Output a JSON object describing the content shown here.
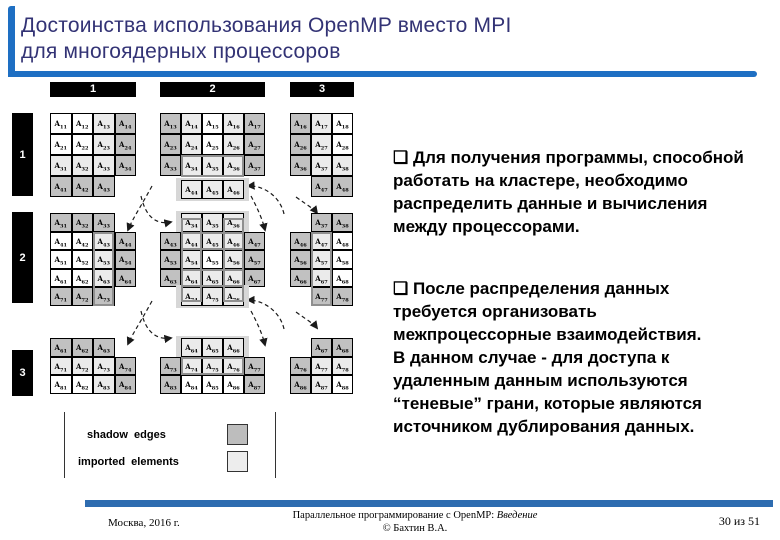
{
  "colors": {
    "accent_blue": "#1e6fc3",
    "title_text": "#333375",
    "footer_bar": "#2e6cb0",
    "shadow_gray": "#c1c1c1",
    "imported_gray": "#ebebeb"
  },
  "title": {
    "line1": "Достоинства использования OpenMP вместо MPI",
    "line2": "для многоядерных процессоров"
  },
  "bullets": {
    "item1": "❑  Для получения программы, способной\nработать на кластере, необходимо\nраспределить данные  и вычисления\nмежду процессорами.",
    "item2": "❑  После распределения данных\nтребуется организовать\nмежпроцессорные взаимодействия.\nВ данном случае - для доступа к\nудаленным данным используются\n“теневые” грани, которые являются\nисточником дублирования данных."
  },
  "legend": {
    "shadow_label": "shadow  edges",
    "shadow_color": "#bdbdbd",
    "imported_label": "imported  elements",
    "imported_color": "#ededed"
  },
  "footer": {
    "left": "Москва, 2016 г.",
    "center_plain": "Параллельное программирование с OpenMP: ",
    "center_italic": "Введение",
    "center_line2": "© Бахтин В.А.",
    "right": "30 из 51"
  },
  "diagram": {
    "col_bars": [
      {
        "x": 50,
        "y": 82,
        "w": 86,
        "h": 15,
        "label": "1"
      },
      {
        "x": 160,
        "y": 82,
        "w": 105,
        "h": 15,
        "label": "2"
      },
      {
        "x": 290,
        "y": 82,
        "w": 64,
        "h": 15,
        "label": "3"
      }
    ],
    "row_bars": [
      {
        "x": 12,
        "y": 113,
        "w": 21,
        "h": 83,
        "label": "1"
      },
      {
        "x": 12,
        "y": 212,
        "w": 21,
        "h": 91,
        "label": "2"
      },
      {
        "x": 12,
        "y": 350,
        "w": 21,
        "h": 46,
        "label": "3"
      }
    ],
    "blocks": [
      {
        "name": "block-1-1",
        "x": 50,
        "y": 113,
        "cw": 21.5,
        "rh": 21,
        "rows": [
          {
            "o": 0,
            "c": [
              "11.w",
              "12.w",
              "13.i",
              "14.s"
            ]
          },
          {
            "o": 0,
            "c": [
              "21.w",
              "22.w",
              "23.i",
              "24.s"
            ]
          },
          {
            "o": 0,
            "c": [
              "31.i",
              "32.i",
              "33.i",
              "34.s"
            ]
          },
          {
            "o": 0,
            "c": [
              "41.s",
              "42.s",
              "43.s"
            ]
          }
        ]
      },
      {
        "name": "block-1-2",
        "x": 160,
        "y": 113,
        "cw": 21,
        "rh": 21,
        "rows": [
          {
            "o": 0,
            "c": [
              "13.s",
              "14.i",
              "15.w",
              "16.i",
              "17.s"
            ]
          },
          {
            "o": 0,
            "c": [
              "23.s",
              "24.i",
              "25.w",
              "26.i",
              "27.s"
            ]
          },
          {
            "o": 0,
            "c": [
              "33.s",
              "34.i",
              "35.i",
              "36.i",
              "37.s"
            ]
          }
        ]
      },
      {
        "name": "block-1-2-imported-strip",
        "x": 181,
        "y": 180,
        "cw": 21,
        "rh": 18.5,
        "band": true,
        "rows": [
          {
            "o": 0,
            "c": [
              "44.i",
              "45.i",
              "46.i"
            ]
          }
        ]
      },
      {
        "name": "block-1-3",
        "x": 290,
        "y": 113,
        "cw": 21,
        "rh": 21,
        "rows": [
          {
            "o": 0,
            "c": [
              "16.s",
              "17.i",
              "18.w"
            ]
          },
          {
            "o": 0,
            "c": [
              "26.s",
              "27.i",
              "28.w"
            ]
          },
          {
            "o": 0,
            "c": [
              "36.s",
              "37.i",
              "38.i"
            ]
          },
          {
            "o": 1,
            "c": [
              "47.s",
              "48.s"
            ]
          }
        ]
      },
      {
        "name": "block-2-1",
        "x": 50,
        "y": 213,
        "cw": 21.5,
        "rh": 18.5,
        "rows": [
          {
            "o": 0,
            "c": [
              "31.s",
              "32.s",
              "33.s"
            ]
          },
          {
            "o": 0,
            "c": [
              "41.w",
              "42.w",
              "43.i",
              "44.s"
            ]
          },
          {
            "o": 0,
            "c": [
              "51.w",
              "52.w",
              "53.i",
              "54.s"
            ]
          },
          {
            "o": 0,
            "c": [
              "61.w",
              "62.w",
              "63.i",
              "64.s"
            ]
          },
          {
            "o": 0,
            "c": [
              "71.s",
              "72.s",
              "73.s"
            ]
          }
        ]
      },
      {
        "name": "block-2-2-top-strip",
        "x": 181,
        "y": 213,
        "cw": 21,
        "rh": 18.5,
        "band": true,
        "rows": [
          {
            "o": 0,
            "c": [
              "34.i",
              "35.i",
              "36.i"
            ]
          }
        ]
      },
      {
        "name": "block-2-2",
        "x": 160,
        "y": 231.5,
        "cw": 21,
        "rh": 18.5,
        "rows": [
          {
            "o": 0,
            "c": [
              "43.s",
              "44.i",
              "45.i",
              "46.i",
              "47.s"
            ]
          },
          {
            "o": 0,
            "c": [
              "53.s",
              "54.i",
              "55.w",
              "56.i",
              "57.s"
            ]
          },
          {
            "o": 0,
            "c": [
              "63.s",
              "64.i",
              "65.i",
              "66.i",
              "67.s"
            ]
          }
        ]
      },
      {
        "name": "block-2-2-bottom-strip",
        "x": 181,
        "y": 287,
        "cw": 21,
        "rh": 18.5,
        "band": true,
        "rows": [
          {
            "o": 0,
            "c": [
              "74.i",
              "75.i",
              "76.i"
            ]
          }
        ]
      },
      {
        "name": "block-2-3",
        "x": 290,
        "y": 213,
        "cw": 21,
        "rh": 18.5,
        "rows": [
          {
            "o": 1,
            "c": [
              "37.s",
              "38.s"
            ]
          },
          {
            "o": 0,
            "c": [
              "46.s",
              "47.i",
              "48.w"
            ]
          },
          {
            "o": 0,
            "c": [
              "56.s",
              "57.i",
              "58.w"
            ]
          },
          {
            "o": 0,
            "c": [
              "66.s",
              "67.i",
              "68.w"
            ]
          },
          {
            "o": 1,
            "c": [
              "77.s",
              "78.s"
            ]
          }
        ]
      },
      {
        "name": "block-3-1",
        "x": 50,
        "y": 338,
        "cw": 21.5,
        "rh": 18.5,
        "rows": [
          {
            "o": 0,
            "c": [
              "61.s",
              "62.s",
              "63.s"
            ]
          },
          {
            "o": 0,
            "c": [
              "71.i",
              "72.i",
              "73.i",
              "74.s"
            ]
          },
          {
            "o": 0,
            "c": [
              "81.w",
              "82.w",
              "83.i",
              "84.s"
            ]
          }
        ]
      },
      {
        "name": "block-3-2-top-strip",
        "x": 181,
        "y": 338,
        "cw": 21,
        "rh": 18.5,
        "band": true,
        "rows": [
          {
            "o": 0,
            "c": [
              "64.i",
              "65.i",
              "66.i"
            ]
          }
        ]
      },
      {
        "name": "block-3-2",
        "x": 160,
        "y": 356.5,
        "cw": 21,
        "rh": 18.5,
        "rows": [
          {
            "o": 0,
            "c": [
              "73.s",
              "74.i",
              "75.i",
              "76.i",
              "77.s"
            ]
          },
          {
            "o": 0,
            "c": [
              "83.s",
              "84.w",
              "85.w",
              "86.w",
              "87.s"
            ]
          }
        ]
      },
      {
        "name": "block-3-3",
        "x": 290,
        "y": 338,
        "cw": 21,
        "rh": 18.5,
        "rows": [
          {
            "o": 1,
            "c": [
              "67.s",
              "68.s"
            ]
          },
          {
            "o": 0,
            "c": [
              "76.s",
              "77.i",
              "78.i"
            ]
          },
          {
            "o": 0,
            "c": [
              "86.s",
              "87.i",
              "88.w"
            ]
          }
        ]
      }
    ],
    "boxes": [
      {
        "x": 181,
        "y": 155,
        "w": 63,
        "h": 22
      },
      {
        "x": 92.5,
        "y": 231.5,
        "w": 21.5,
        "h": 74
      },
      {
        "x": 311,
        "y": 231.5,
        "w": 21,
        "h": 74
      },
      {
        "x": 181,
        "y": 231.5,
        "w": 63,
        "h": 18.5
      },
      {
        "x": 181,
        "y": 268.5,
        "w": 63,
        "h": 18.5
      },
      {
        "x": 181,
        "y": 218,
        "w": 21,
        "h": 84
      },
      {
        "x": 223,
        "y": 218,
        "w": 21,
        "h": 84
      },
      {
        "x": 181,
        "y": 356.5,
        "w": 63,
        "h": 18.5
      }
    ],
    "lines": [
      {
        "x": 64,
        "y": 412,
        "h": 66
      },
      {
        "x": 275,
        "y": 412,
        "h": 66
      }
    ],
    "arrows": [
      "M152,186 C140,208 133,218 128,230",
      "M141,196 C146,218 157,225 171,222",
      "M284,214 C280,196 263,185 248,186",
      "M251,196 C260,213 263,222 265,230",
      "M296,197 C307,205 314,209 317,213",
      "M152,301 C140,323 133,333 128,344",
      "M141,311 C146,333 157,340 171,338",
      "M284,329 C280,311 263,300 248,300",
      "M251,311 C260,328 263,337 265,345",
      "M296,312 C307,320 314,324 317,328"
    ]
  }
}
